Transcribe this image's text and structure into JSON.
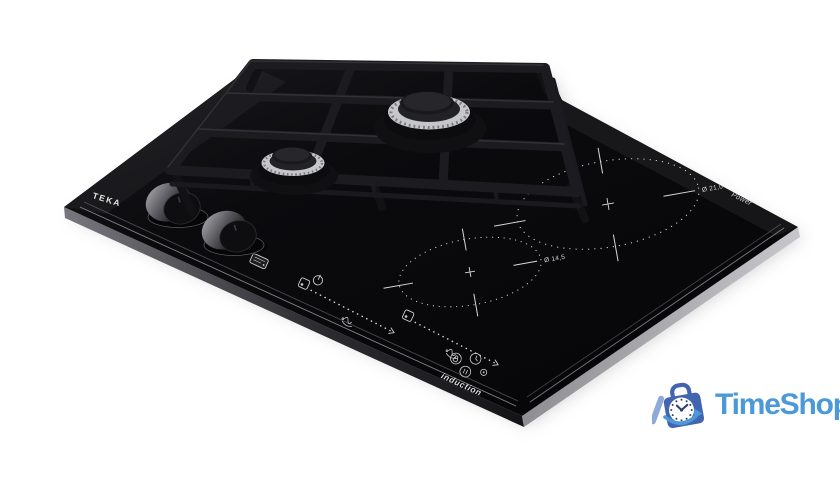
{
  "page": {
    "background": "#ffffff"
  },
  "product": {
    "kind": "hybrid gas and induction hob product photo",
    "brand": "TEKA",
    "labels": {
      "induction": "induction",
      "power_corner": "Power",
      "zone_large_diameter": "Ø 21,0",
      "zone_small_diameter": "Ø 14,5"
    },
    "colors": {
      "glass": "#0a0a0d",
      "grid": "#17171b",
      "burner_chrome": "#c6c7cb",
      "marking_white": "#d9d9dd",
      "front_face_light": "#77777d",
      "right_face_light": "#c0c0c5"
    },
    "icons": [
      "gas-badge-icon",
      "power-icon",
      "zone-select-icon",
      "slider-track",
      "swipe-gesture-icon",
      "lock-button-icon",
      "timer-button-icon",
      "pause-button-icon",
      "dot-button-icon",
      "gas-burner",
      "pan-support-grid",
      "control-knob",
      "induction-zone-ring"
    ]
  },
  "logo": {
    "text": "TimeShop",
    "colors": {
      "bag": "#4365b0",
      "stripe": "#8fa9da",
      "clock_face": "#ffffff",
      "clock_hands": "#2e4070",
      "swoosh": "#4b99d8",
      "text": "#4b99d8"
    }
  }
}
